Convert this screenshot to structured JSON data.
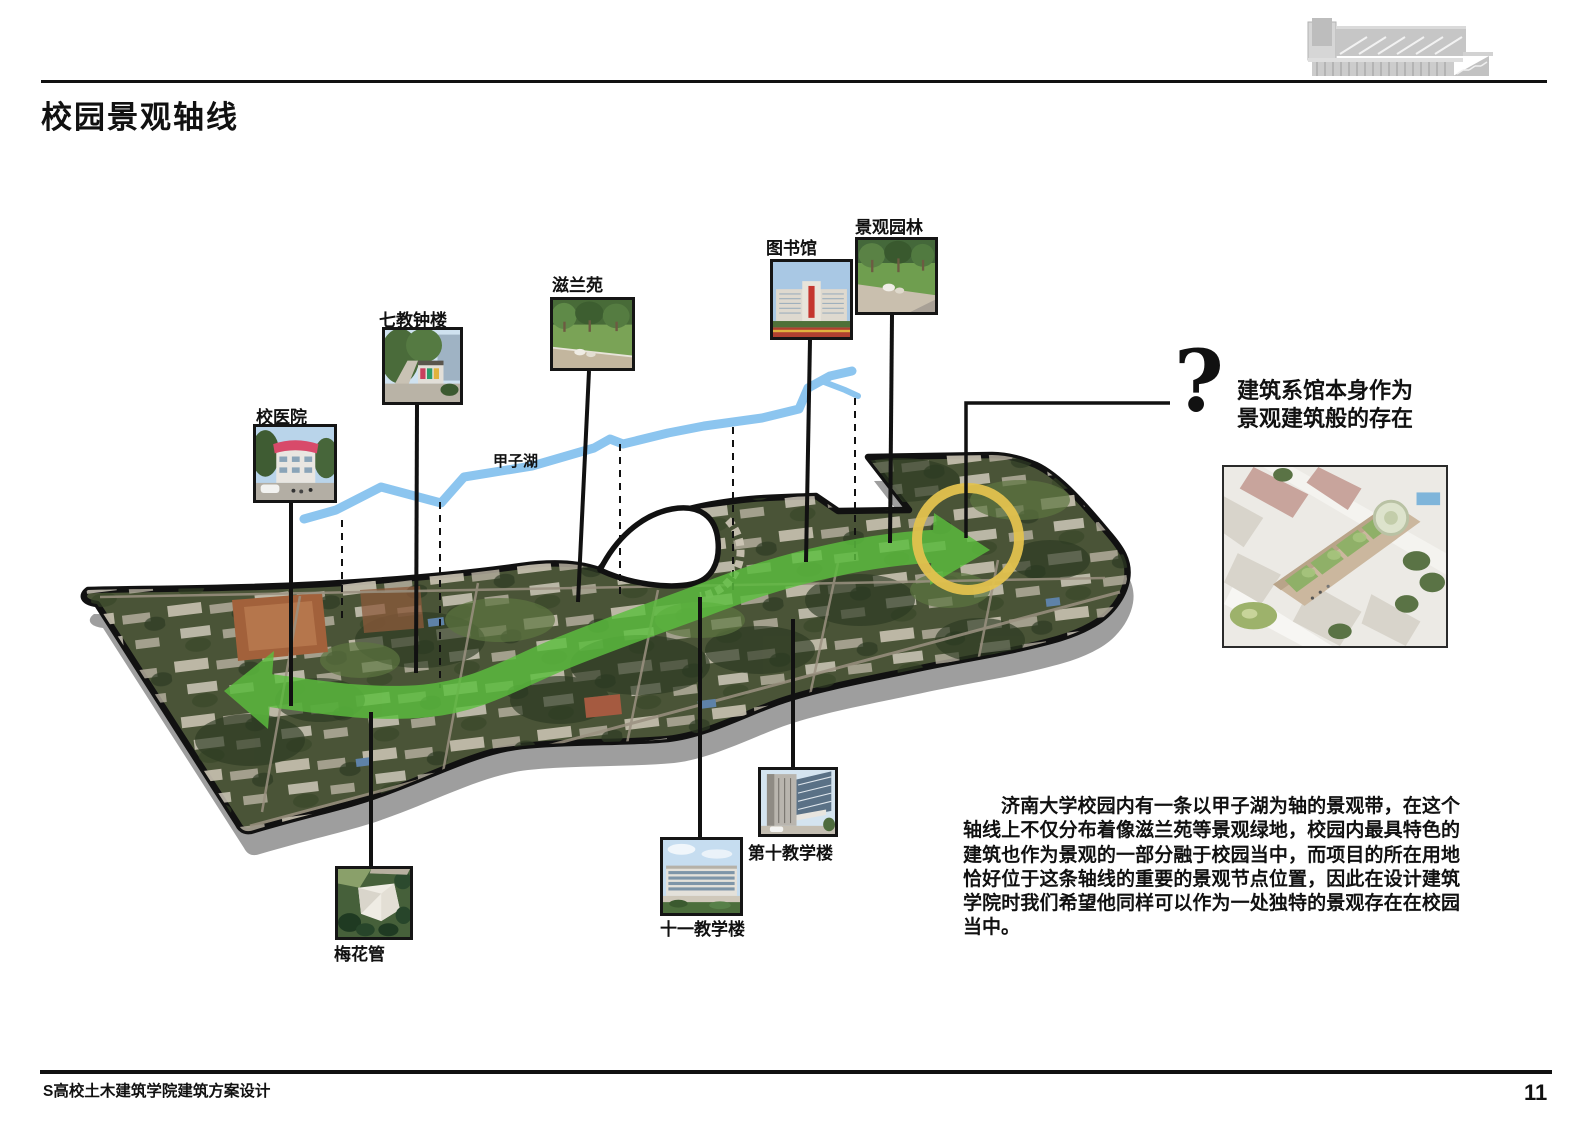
{
  "page": {
    "title": "校园景观轴线",
    "footer_left": "S高校土木建筑学院建筑方案设计",
    "page_number": "11"
  },
  "diagram": {
    "lake_label": "甲子湖",
    "question_mark": "?",
    "annotation_line1": "建筑系馆本身作为",
    "annotation_line2": "景观建筑般的存在",
    "callouts": [
      {
        "label": "校医院"
      },
      {
        "label": "七教钟楼"
      },
      {
        "label": "滋兰苑"
      },
      {
        "label": "图书馆"
      },
      {
        "label": "景观园林"
      },
      {
        "label": "梅花管"
      },
      {
        "label": "十一教学楼"
      },
      {
        "label": "第十教学楼"
      }
    ]
  },
  "paragraph": "济南大学校园内有一条以甲子湖为轴的景观带，在这个轴线上不仅分布着像滋兰苑等景观绿地，校园内最具特色的建筑也作为景观的一部分融于校园当中，而项目的所在用地恰好位于这条轴线的重要的景观节点位置，因此在设计建筑学院时我们希望他同样可以作为一处独特的景观存在在校园当中。",
  "colors": {
    "axis_arrow_green": "#5cbe3e",
    "node_circle_yellow": "#e3c24e",
    "lake_blue": "#8cc5ef",
    "map_outline": "#111111",
    "shadow_gray": "#9e9e9e"
  }
}
